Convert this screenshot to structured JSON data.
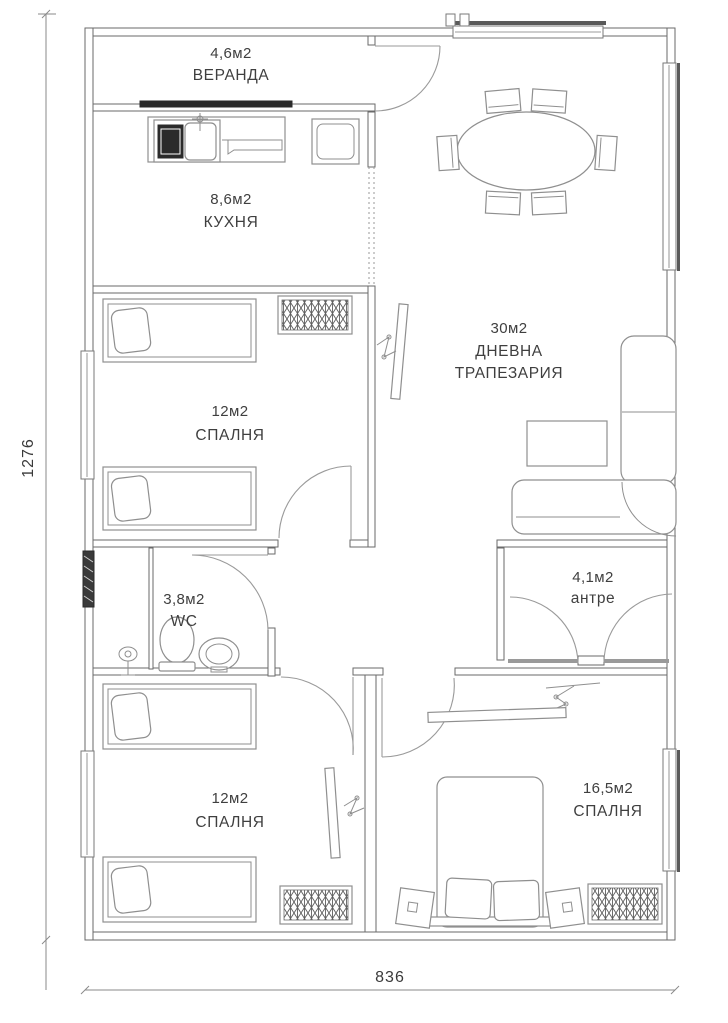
{
  "drawing": {
    "type": "apartment-floor-plan",
    "rooms": {
      "veranda": {
        "area": "4,6м2",
        "name": "ВЕРАНДА"
      },
      "kitchen": {
        "area": "8,6м2",
        "name": "КУХНЯ"
      },
      "living": {
        "area": "30м2",
        "name_line1": "ДНЕВНА",
        "name_line2": "ТРАПЕЗАРИЯ"
      },
      "bedroom_mid": {
        "area": "12м2",
        "name": "СПАЛНЯ"
      },
      "wc": {
        "area": "3,8м2",
        "name": "WC"
      },
      "antre": {
        "area": "4,1м2",
        "name": "антре"
      },
      "bedroom_bl": {
        "area": "12м2",
        "name": "СПАЛНЯ"
      },
      "bedroom_br": {
        "area": "16,5м2",
        "name": "СПАЛНЯ"
      }
    },
    "dimensions": {
      "height_label": "1276",
      "width_label": "836"
    },
    "colors": {
      "background": "#ffffff",
      "wall_line": "#6a6a6a",
      "furniture_line": "#8f8f8f",
      "dark_fill": "#2b2b2b",
      "text": "#3f3f3f"
    }
  }
}
